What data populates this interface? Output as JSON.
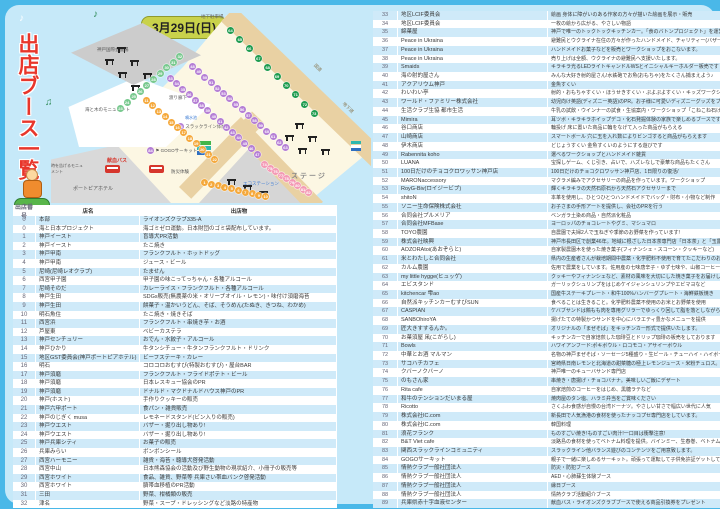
{
  "page": {
    "title_vertical": "出店ブース一覧",
    "date_badge": "3月29日(日)"
  },
  "colors": {
    "frame_blue": "#4ab8e8",
    "panel_blue": "#c6e9f9",
    "row_alt_blue": "#cfeaf9",
    "title_red": "#e8362b",
    "badge_green": "#c9d24b",
    "plaza_cream": "#fcf7e3",
    "road_tan": "#e9d1a3",
    "marker_green": "#1f9c50",
    "marker_purple": "#b57fd5",
    "marker_orange": "#f5a93c",
    "marker_teal": "#79c98f",
    "marker_pink": "#f49ab5",
    "bus_red": "#d6362c"
  },
  "map": {
    "labels": {
      "kobe_hall": "神戸国際会議場",
      "sea_monument": "海と木のモニュメント",
      "corridor": "渡り廊下",
      "slackline": "スラックライン体験",
      "slackline_num": "83",
      "gogo": "GOGOサーキット",
      "gogo_num": "84",
      "blood_bus": "献血バス",
      "bosai": "防災体験",
      "clock_monument": "時を告げるモニュメント",
      "hotel": "ポートピアホテル",
      "stage": "ステージ",
      "parking": "地下駐車場",
      "road": "国道",
      "underpass": "地下道",
      "fountain": "噴水池",
      "eco": "エコステーション"
    },
    "chains": [
      {
        "id": "teal",
        "color": "#79c98f",
        "numbers": [
          23,
          24,
          25,
          26,
          27,
          28,
          29,
          30,
          31,
          32
        ]
      },
      {
        "id": "orangeA",
        "color": "#f5a93c",
        "numbers": [
          11,
          12,
          13,
          14,
          15,
          16,
          17,
          18,
          19,
          20,
          21,
          22
        ]
      },
      {
        "id": "purpleA",
        "color": "#b57fd5",
        "numbers": [
          33,
          34,
          35,
          36,
          37,
          38,
          39,
          40,
          41,
          42,
          43,
          44,
          45,
          46,
          47
        ]
      },
      {
        "id": "purpleB",
        "color": "#b57fd5",
        "numbers": [
          48,
          49,
          50,
          51,
          52,
          53,
          54,
          55,
          56,
          57,
          58,
          59,
          60,
          61,
          62,
          63
        ]
      },
      {
        "id": "green",
        "color": "#1f9c50",
        "numbers": [
          64,
          65,
          66,
          67,
          68,
          69,
          70,
          71,
          72,
          73
        ]
      },
      {
        "id": "orangeB",
        "color": "#f5a93c",
        "numbers": [
          1,
          2,
          3,
          4,
          5,
          6,
          7,
          8,
          9,
          10
        ]
      },
      {
        "id": "pink",
        "color": "#f49ab5",
        "numbers": [
          74,
          75,
          76,
          77,
          78,
          79,
          80,
          81,
          82
        ]
      }
    ]
  },
  "left_table": {
    "headers": [
      "出店番号",
      "店名",
      "出店物"
    ],
    "rows": [
      [
        "0",
        "本部",
        "ライオンズクラブ335-A"
      ],
      [
        "0",
        "海と日本プロジェクト",
        "海ゴミゼロ運動。日本財団のゴミ袋配布しています。"
      ],
      [
        "1",
        "神戸イースト",
        "盲導犬PR活動"
      ],
      [
        "2",
        "神戸イースト",
        "たこ焼き"
      ],
      [
        "3",
        "神戸甲南",
        "フランクフルト・ホットドッグ"
      ],
      [
        "4",
        "神戸甲南",
        "ジュース・ビール"
      ],
      [
        "5",
        "尼崎(尼崎レオクラブ)",
        "たません"
      ],
      [
        "6",
        "西宮甲子園",
        "甲子園の味こってっちゃん・各種アルコール"
      ],
      [
        "7",
        "尼崎そのだ",
        "カレーライス・フランクフルト・各種アルコール"
      ],
      [
        "8",
        "神戸生田",
        "SDGs販売(無農薬の米・オリーブオイル・レモン)・味付け須磨海苔"
      ],
      [
        "9",
        "神戸生田",
        "餅菓子・温かいうどん、そば、そうめん(たぬき、きつね、わかめ)"
      ],
      [
        "10",
        "明石魚住",
        "たこ焼き・焼きそば"
      ],
      [
        "11",
        "西宮浜",
        "フランクフルト・串焼き芋・お酒"
      ],
      [
        "12",
        "芦屋東",
        "ベビーカステラ"
      ],
      [
        "13",
        "神戸センチュリー",
        "おでん・水餃子・アルコール"
      ],
      [
        "14",
        "神戸ひかり",
        "牛タンシチュー・牛タンフランクフルト・ドリンク"
      ],
      [
        "15",
        "地区GST委員会(神戸ポートピアホテル)",
        "ビーフステーキ・カレー"
      ],
      [
        "16",
        "明石",
        "コロコロおむすび(特製おむすび)・屋台BAR"
      ],
      [
        "17",
        "神戸須磨",
        "フランクフルト・フライドポテト・ビール"
      ],
      [
        "18",
        "神戸須磨",
        "日本レスキュー協会のPR"
      ],
      [
        "19",
        "神戸須磨",
        "ドナルド・マクドナルドハウス神戸のPR"
      ],
      [
        "20",
        "神戸(ホスト)",
        "手作りクッキーの販売"
      ],
      [
        "21",
        "神戸六甲ポート",
        "食パン・雑貨販売"
      ],
      [
        "22",
        "神戸のじぎく musa",
        "レモネードスタンド(ビン入りの販売)"
      ],
      [
        "23",
        "神戸ウエスト",
        "バザー・掘り出し物あり!"
      ],
      [
        "24",
        "神戸ウエスト",
        "バザー・掘り出し物あり!"
      ],
      [
        "25",
        "神戸兵庫シティ",
        "お菓子の販売"
      ],
      [
        "26",
        "兵庫みらい",
        "ボンボンシール"
      ],
      [
        "27",
        "西宮ハーモニー",
        "雑貨・海苔・聴導犬啓発活動"
      ],
      [
        "28",
        "西宮中山",
        "日本熊森協会の活動及び野生動物の現状紹介、小冊子の販売等"
      ],
      [
        "29",
        "西宮ホワイト",
        "食品、雑貨、野菜等 兵庫さい帯血バンク啓発活動"
      ],
      [
        "30",
        "西宮ホワイト",
        "臍帯血移植のPR活動"
      ],
      [
        "31",
        "三田",
        "野菜、柑橘類の販売"
      ],
      [
        "32",
        "津名",
        "野菜・スープ・ドレッシングなど淡路の特産物"
      ]
    ]
  },
  "right_table": {
    "rows": [
      [
        "33",
        "地区LCIF委員会",
        "絵画 身体に障がいのある作家の方々が描いた絵画を展示・販売"
      ],
      [
        "34",
        "地区LCIF委員会",
        "一枚の絵から広がる、やさしい物語"
      ],
      [
        "35",
        "綿菓屋",
        "神戸で唯一のトックトックキッチンカー。「食のバトンプロジェクト」を運営中。"
      ],
      [
        "36",
        "Peace in Ukraina",
        "避難民とウクライナ在住の方々が作ったハンドメイド、チャリティー(バザー)(新品)。"
      ],
      [
        "37",
        "Peace in Ukraina",
        "ハンドメイドお菓子などを販売とワークショップをおこないます。"
      ],
      [
        "38",
        "Peace in Ukraina",
        "売り上げは全額、ウクライナの避難民へ支援いたします。"
      ],
      [
        "39",
        "Smaids",
        "キラキラ光るLEDライトキャンドルWSとイニシャルキーホルダー販売です"
      ],
      [
        "40",
        "海の射的屋さん",
        "みんな大好き射的屋さん!水鉄砲でお魚(おもちゃ)をたくさん捕まえよう♪"
      ],
      [
        "41",
        "アクアリウム神戸",
        "金魚すくい"
      ],
      [
        "42",
        "わいわい亭",
        "射的・おもちゃすくい・ほうせきすくい・ぷよぷよすくい・キッズワークショップ"
      ],
      [
        "43",
        "ワールド・ファミリー株式会社",
        "幼児向け英語(ディズニー英語)のPR。お子様に可愛いディズニーグッズをプレゼント♪"
      ],
      [
        "44",
        "生活クラブ生協 都市生活",
        "牛乳の試飲・ウインナーの試食・生協案内・ワークショップ「こねこね石けん」"
      ],
      [
        "45",
        "Mimira",
        "耳ツボ・キラキラホイップデコ・化石発掘体験の家族で楽しめるブースです♪"
      ],
      [
        "46",
        "谷口商店",
        "輪投げ 床に置いた商品に輪をなげて入った商品がもらえる"
      ],
      [
        "47",
        "山崎商店",
        "スマートボール 穴に玉を入れ数によりビンゴすると商品がもらえます"
      ],
      [
        "48",
        "伊木商店",
        "どじょうすくい 金魚すくいのようにする遊びです"
      ],
      [
        "49",
        "Rabennita koho",
        "選べるワークショップとハンドメイド雑貨"
      ],
      [
        "50",
        "LUANA",
        "宝探しゲーム、くじ引き、占いで、ハズレなしで豪華な商品もたくさん"
      ],
      [
        "51",
        "100日だけのチョコクロワッサン神戸店",
        "100日だけのチョコクロワッサン神戸店、1日限りの復活/"
      ],
      [
        "52",
        "MARONaccessory",
        "マクラメ編みでアクセサリーの商品を作っています。ワークショップ"
      ],
      [
        "53",
        "RoyG-Biv(ロイジービブ)",
        "輝くキラキラの天然石原石から天然石アクセサリーまで"
      ],
      [
        "54",
        "shitoN",
        "本革を使用し、ひとつひとつハンドメイドでバッグ・財布・小物など制作"
      ],
      [
        "55",
        "ソニー生命保険株式会社",
        "お子さまの手形アートを提供し、会社のPRを行う"
      ],
      [
        "56",
        "合同会社プルメリア",
        "ベンガラ土染め商品・自然派化粧品"
      ],
      [
        "57",
        "合同会社MFBase",
        "ヨーロッパのチョコレートやグミ、マシュマロ"
      ],
      [
        "58",
        "TOYO農園",
        "自農園で夫婦2人で玉ねぎや季節のお野菜を作っています!"
      ],
      [
        "59",
        "株式会社映興",
        "神戸市長田区で創業46年。地域に根ざした日本茶専門店「日本茶」と「玉露あめ」"
      ],
      [
        "60",
        "AOZORAtoi(あおぞらと)",
        "自家製農園木を使った焼き菓子(フィナンシェ・スコーン・クッキーなど)"
      ],
      [
        "61",
        "米とわたしと合同会社",
        "県内の生産者さんが栽培期間中農薬・化学肥料不使用で育てたこだわりのお米"
      ],
      [
        "62",
        "カルム農園",
        "佐用で農業をしています。佐用産の七味唐辛子・ゆず七味や、山椒コーヒーなど。"
      ],
      [
        "63",
        "my little hygge(ヒュッゲ)",
        "クッキーやフィナンシェなど、素材の風味を大切にした焼き菓子をお届けします。"
      ],
      [
        "64",
        "エビスタンド",
        "ガーリックシュリンプをはじめケイジャンシュリンプやエビマヨなど"
      ],
      [
        "65",
        "kitchencar 雫ao",
        "国産牛ステーキプレート・和牛100%ハンバーグプレート・海鮮鉄板焼き"
      ],
      [
        "66",
        "自然派キッチンカーむすびSUN",
        "食べることは生きること。化学肥料農薬不使用のお米とお野菜を使用"
      ],
      [
        "67",
        "CASPIAN",
        "ケバブサンドは鶏もも肉を専用グリラーでゆっくり回して脂を落としながら焼き上げます。"
      ],
      [
        "68",
        "SANBOhiroYA",
        "揚げたての特製かつサンドを中心にバラエティ豊かなメニューを提供"
      ],
      [
        "69",
        "匠大きすするんか。",
        "オリジナルの「まぜそば」をキッチンカー形式で提供いたします。"
      ],
      [
        "70",
        "お菓須屋 凩(こがらし)",
        "キッチンカーで自家焙煎した珈琲豆とドリップ珈琲の販売をしております"
      ],
      [
        "71",
        "Bowls",
        "ハワイアンフード:ポキボウル・ロコモコ・アサイーボウル"
      ],
      [
        "72",
        "中華とお酒 マルマン",
        "名物の神戸まぜそば・ソーセージ5種盛り・生ビール・チューハイ・ハイボール"
      ],
      [
        "73",
        "サコハチカフェ",
        "宮崎県日南レモンと北海道の甜菜糖の極上レモンジュース・米粉チュロス。"
      ],
      [
        "74",
        "クバーノクバーノ",
        "神戸唯一のキューバサンド専門店"
      ],
      [
        "75",
        "のもさん家",
        "串焼き・唐揚げ・チョコバナナ。美味しいご飯にデザート"
      ],
      [
        "76",
        "Rita cafe",
        "自家焙煎のコーヒーをはじめ、黒糖ラテなど"
      ],
      [
        "77",
        "和牛のテンションだいまる屋",
        "焼肉屋のタン塩、ハラミ弁当をご賞味ください"
      ],
      [
        "78",
        "Ricotto",
        "さくふわ食感が自慢の台湾ドーナツ。やさしい甘さで幅広い世代に人気"
      ],
      [
        "79",
        "株式会社IC.com",
        "新長田で人気漁港の食材を使ったナッコプセ専門店をしています。"
      ],
      [
        "80",
        "株式会社IC.com",
        "韓国料理"
      ],
      [
        "81",
        "浪花フランク",
        "ものすごい焼き!ものすごい肉汁!一口目は衝撃注意!"
      ],
      [
        "82",
        "B&T Viet cafe",
        "淡路島の食材を使ってベトナム料理を提供。バインミー、生春巻、ベトナムコーヒー"
      ],
      [
        "83",
        "関西スラックラインコミュニティ",
        "スラックライン他バランス遊びのコンテンツをご用意致します。"
      ],
      [
        "84",
        "GOGOサーキット",
        "親子で一緒に楽しめるサーキット。頑張って運転して子供免許証ゲットしてね!"
      ],
      [
        "85",
        "情熱クラブ一般社団法人",
        "防災・防犯ブース"
      ],
      [
        "86",
        "情熱クラブ一般社団法人",
        "AED・心肺蘇生体験ブース"
      ],
      [
        "87",
        "情熱クラブ一般社団法人",
        "縁日ブース"
      ],
      [
        "88",
        "情熱クラブ一般社団法人",
        "情熱クラブ活動紹介ブース"
      ],
      [
        "89",
        "兵庫県赤十字血液センター",
        "献血バス・ライオンズクラブブースで使える商品引換券をプレゼント"
      ]
    ]
  }
}
